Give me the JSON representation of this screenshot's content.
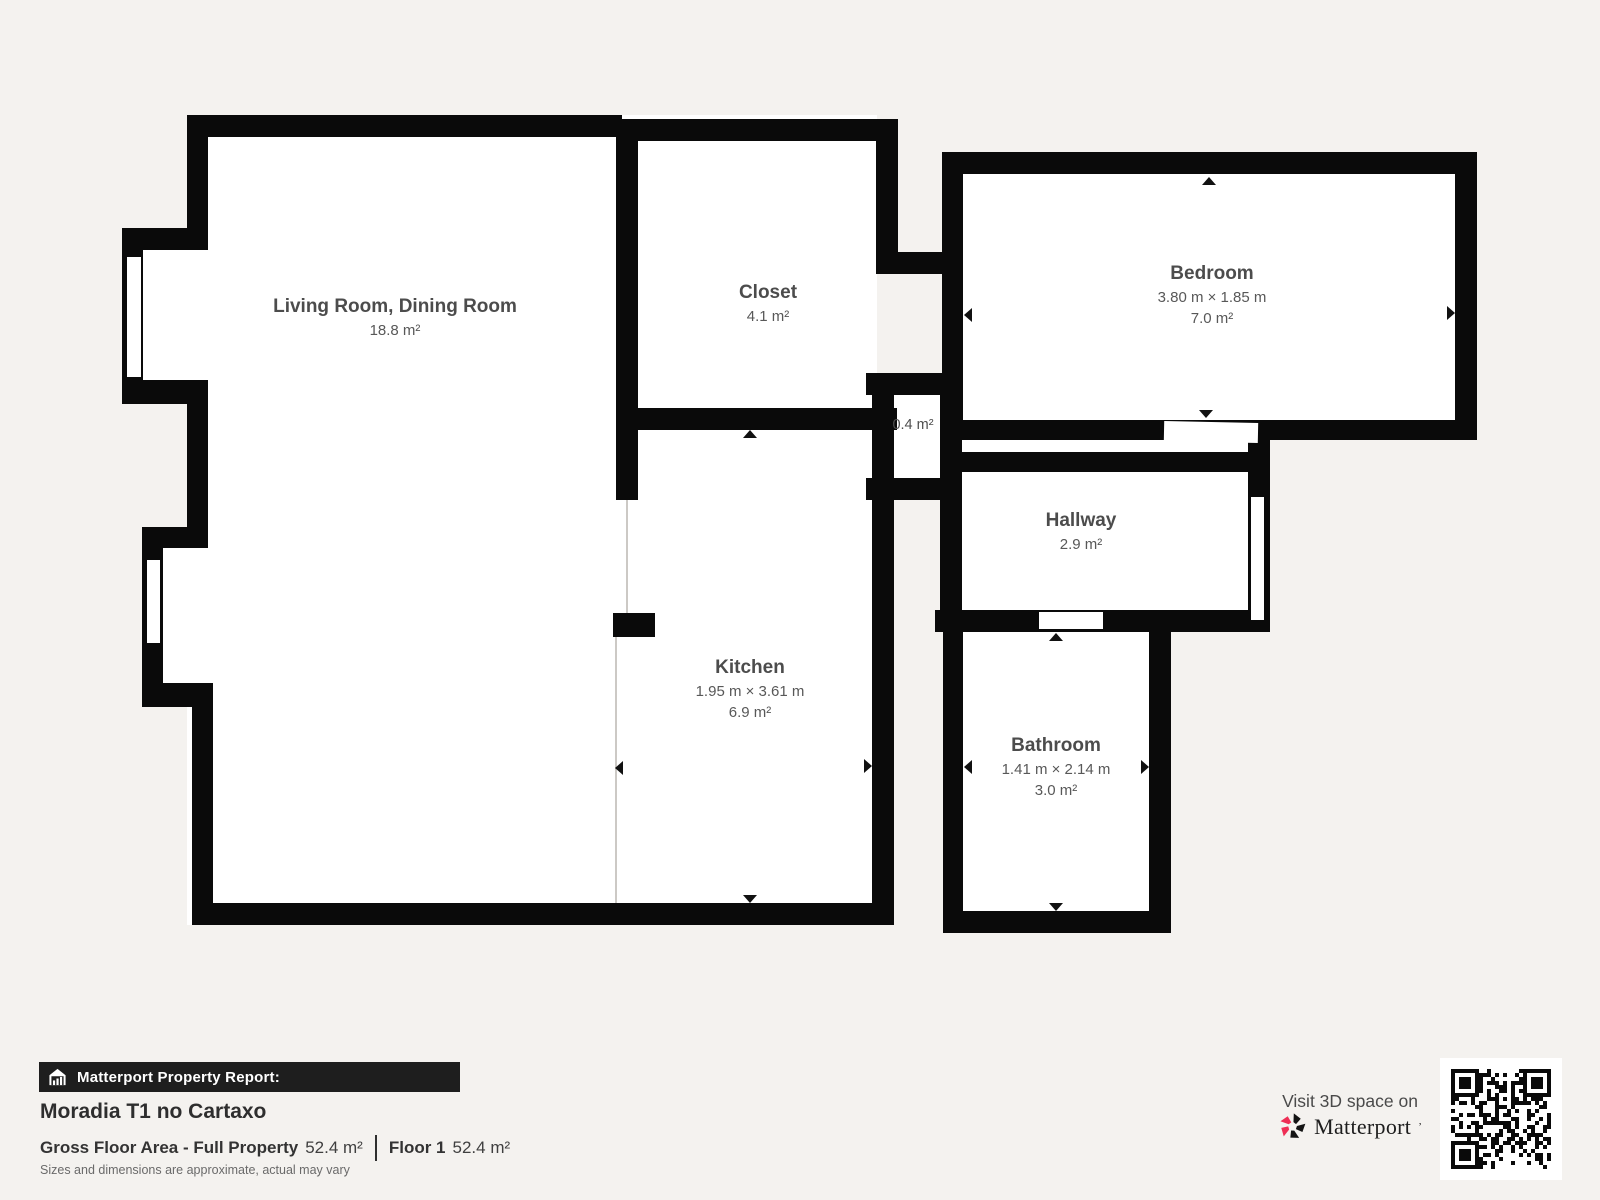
{
  "plan": {
    "rooms": {
      "living_room": {
        "name": "Living Room, Dining Room",
        "area": "18.8 m²"
      },
      "closet": {
        "name": "Closet",
        "area": "4.1 m²"
      },
      "bedroom": {
        "name": "Bedroom",
        "dimensions": "3.80 m × 1.85 m",
        "area": "7.0 m²"
      },
      "nook": {
        "area": "0.4 m²"
      },
      "hallway": {
        "name": "Hallway",
        "area": "2.9 m²"
      },
      "kitchen": {
        "name": "Kitchen",
        "dimensions": "1.95 m × 3.61 m",
        "area": "6.9 m²"
      },
      "bathroom": {
        "name": "Bathroom",
        "dimensions": "1.41 m × 2.14 m",
        "area": "3.0 m²"
      }
    }
  },
  "report": {
    "icon": "house-chart-icon",
    "header": "Matterport Property Report:",
    "property_title": "Moradia T1 no Cartaxo",
    "gross_area_label": "Gross Floor Area - Full Property",
    "gross_area_value": "52.4 m²",
    "floor_label": "Floor 1",
    "floor_value": "52.4 m²",
    "disclaimer": "Sizes and dimensions are approximate, actual may vary"
  },
  "promo": {
    "visit_text": "Visit 3D space on",
    "brand": "Matterport",
    "brand_mark": "ʼ",
    "logo_icon": "matterport-pinwheel-logo",
    "qr_icon": "qr-code"
  },
  "colors": {
    "background": "#f4f2ef",
    "wall": "#0a0a0a",
    "room_fill": "#ffffff",
    "label_text": "#4c4c4c",
    "brand_red": "#ee2e55",
    "report_bar_bg": "#1e1e1e"
  }
}
